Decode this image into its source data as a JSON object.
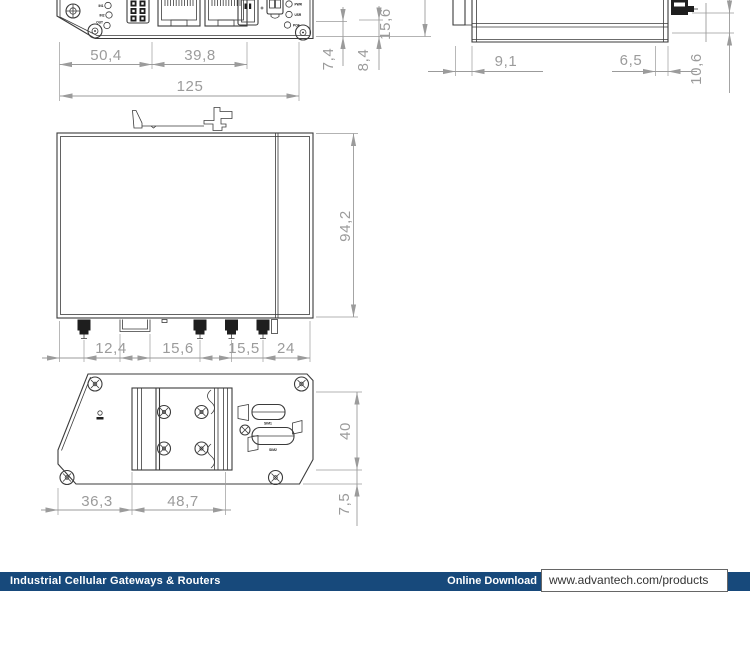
{
  "footer": {
    "category": "Industrial Cellular Gateways & Routers",
    "download_label": "Online Download",
    "url": "www.advantech.com/products"
  },
  "colors": {
    "footer_bar": "#17497B",
    "drawing_line": "#3B3B3B",
    "dimension": "#9B9B9B"
  },
  "front": {
    "led_labels_left": [
      "IN1",
      "IN2",
      "OUT"
    ],
    "led_labels_right": [
      "PWR",
      "USR",
      "POE"
    ]
  },
  "rear": {
    "sim_label_1": "SIM1",
    "sim_label_2": "SIM2"
  },
  "dims": {
    "d50_4": "50,4",
    "d39_8": "39,8",
    "d125": "125",
    "d7_4": "7,4",
    "d8_4": "8,4",
    "d15_6a": "15,6",
    "d9_1": "9,1",
    "d6_5": "6,5",
    "d10_6": "10,6",
    "d94_2": "94,2",
    "d12_4": "12,4",
    "d15_6b": "15,6",
    "d15_5": "15,5",
    "d24": "24",
    "d36_3": "36,3",
    "d48_7": "48,7",
    "d40": "40",
    "d7_5": "7,5"
  }
}
